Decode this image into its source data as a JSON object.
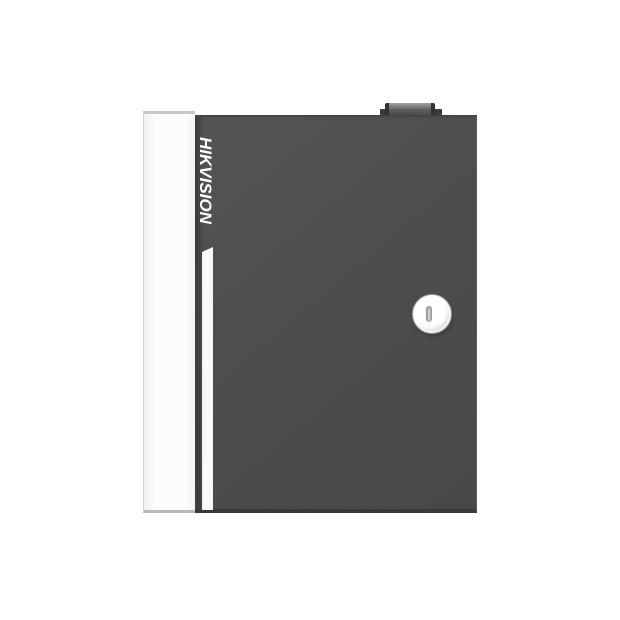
{
  "page": {
    "type": "product-photo",
    "background": "#ffffff"
  },
  "product": {
    "brand": "HIKVISION",
    "colors": {
      "background": "#ffffff",
      "door": "#4c4c4c",
      "door_edge_bottom": "#393939",
      "side_panel": "#fcfcfc",
      "accent_stripe": "#fcfcfc",
      "logo_text": "#ffffff",
      "lock_face": "#ffffff",
      "tamper_switch": "#5f5f5f"
    },
    "elements": [
      "tamper-switch",
      "enclosure-side-panel",
      "enclosure-door",
      "brand-logo",
      "accent-stripe",
      "door-lock",
      "keyhole-icon"
    ]
  }
}
